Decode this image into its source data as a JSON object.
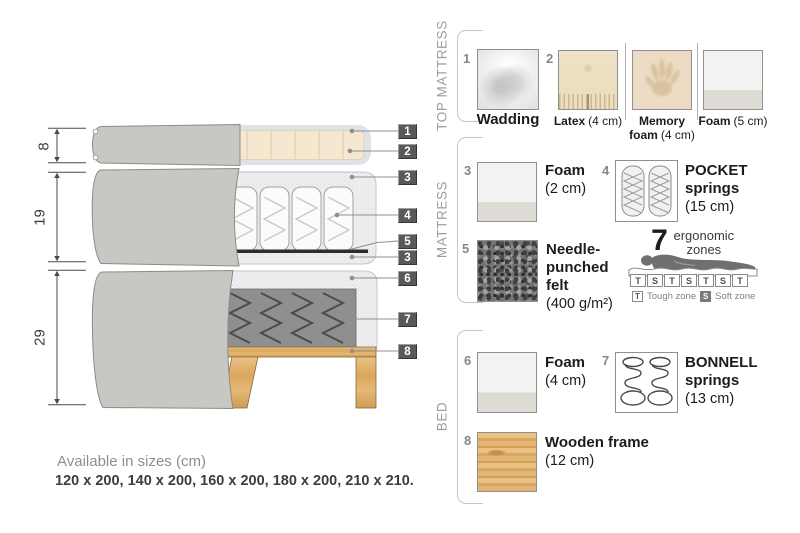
{
  "colors": {
    "fabric_gray": "#c7c8c3",
    "foam_speckle": "#efeff1",
    "latex_cream": "#f4e8d1",
    "wadding_blue_gray": "#dde3e9",
    "felt_dark": "#2d2d2d",
    "wood": "#dfb271",
    "callout_bg": "#595959",
    "section_label_gray": "#9d9d9d",
    "text_dark": "#1c1c1c"
  },
  "diagram": {
    "dim_labels": [
      "8",
      "19",
      "29"
    ],
    "callouts": [
      "1",
      "2",
      "3",
      "4",
      "5",
      "3",
      "6",
      "7",
      "8"
    ]
  },
  "legend": {
    "sections": [
      {
        "title": "TOP MATTRESS"
      },
      {
        "title": "MATTRESS"
      },
      {
        "title": "BED"
      }
    ],
    "items": {
      "wadding": {
        "num": "1",
        "name": "Wadding"
      },
      "latex": {
        "num": "2",
        "name": "Latex",
        "size": "(4 cm)"
      },
      "memory_foam": {
        "name": "Memory foam",
        "size": "(4 cm)"
      },
      "foam_5": {
        "name": "Foam",
        "size": "(5 cm)"
      },
      "foam_2": {
        "num": "3",
        "name": "Foam",
        "size": "(2 cm)"
      },
      "pocket_springs": {
        "num": "4",
        "name": "POCKET springs",
        "size": "(15 cm)"
      },
      "needle_felt": {
        "num": "5",
        "name": "Needle-punched felt",
        "size": "(400 g/m²)"
      },
      "foam_4": {
        "num": "6",
        "name": "Foam",
        "size": "(4 cm)"
      },
      "bonnell_springs": {
        "num": "7",
        "name": "BONNELL springs",
        "size": "(13 cm)"
      },
      "wooden_frame": {
        "num": "8",
        "name": "Wooden frame",
        "size": "(12 cm)"
      }
    }
  },
  "ergonomic": {
    "number": "7",
    "label": "ergonomic zones",
    "zones": [
      "T",
      "S",
      "T",
      "S",
      "T",
      "S",
      "T"
    ],
    "tough_key": "T",
    "tough_label": "Tough zone",
    "soft_key": "S",
    "soft_label": "Soft zone"
  },
  "sizes": {
    "title": "Available in sizes (cm)",
    "values": "120 x 200, 140 x 200, 160 x 200, 180 x 200, 210 x 210."
  }
}
